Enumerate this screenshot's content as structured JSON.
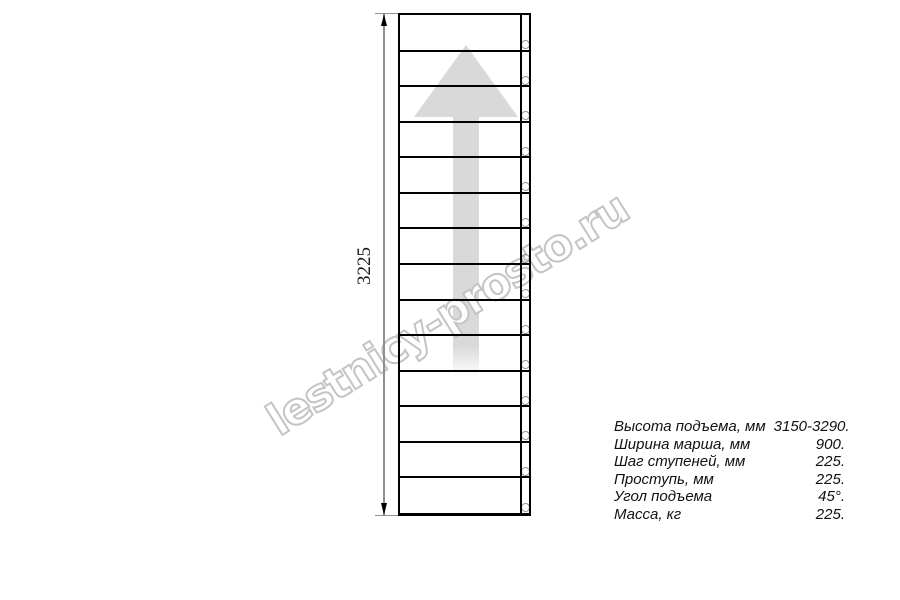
{
  "drawing": {
    "dimension_label": "3225",
    "steps_count": 14
  },
  "watermark": {
    "text": "lestnicy-prosto.ru"
  },
  "specs": {
    "rows": [
      {
        "label": "Высота подъема, мм",
        "value": "3150-3290."
      },
      {
        "label": "Ширина марша, мм",
        "value": "900."
      },
      {
        "label": "Шаг ступеней, мм",
        "value": "225."
      },
      {
        "label": "Проступь, мм",
        "value": "225."
      },
      {
        "label": "Угол подъема",
        "value": "45°."
      },
      {
        "label": "Масса, кг",
        "value": "225."
      }
    ]
  },
  "colors": {
    "drawing_line": "#000000",
    "dimension_line": "#8f8f8f",
    "arrow_fill": "#d9d9d9",
    "watermark_outline": "#c4c4c4",
    "circle_outline": "#8f8f8f"
  }
}
